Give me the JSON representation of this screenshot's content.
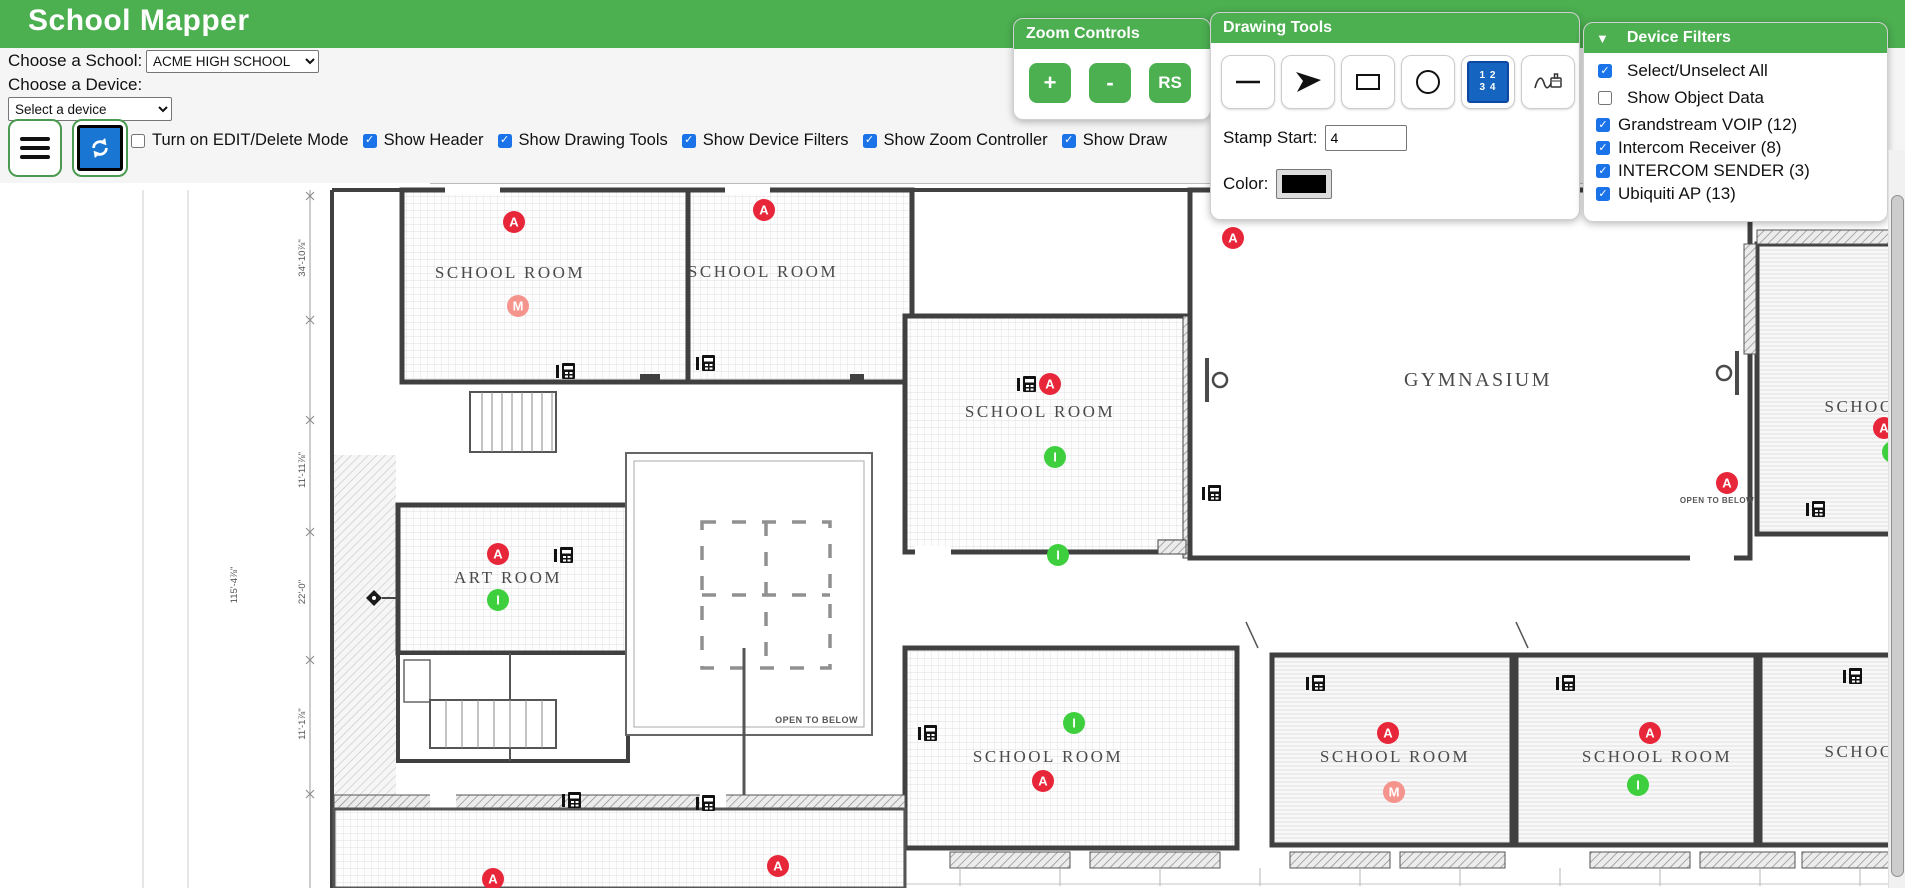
{
  "header": {
    "title": "School Mapper",
    "accent_color": "#4caf50"
  },
  "controls": {
    "school_label": "Choose a School:",
    "school_value": "ACME HIGH SCHOOL",
    "device_label": "Choose a Device:",
    "device_value": "Select a device"
  },
  "option_row": [
    {
      "label": "Turn on EDIT/Delete Mode",
      "checked": false
    },
    {
      "label": "Show Header",
      "checked": true
    },
    {
      "label": "Show Drawing Tools",
      "checked": true
    },
    {
      "label": "Show Device Filters",
      "checked": true
    },
    {
      "label": "Show Zoom Controller",
      "checked": true
    },
    {
      "label": "Show Draw",
      "checked": true
    }
  ],
  "zoom_controls": {
    "title": "Zoom Controls",
    "zoom_in": "+",
    "zoom_out": "-",
    "reset": "RS"
  },
  "drawing_tools": {
    "title": "Drawing Tools",
    "tools": [
      "line",
      "arrow",
      "rectangle",
      "circle",
      "number-stamp",
      "freehand-stamp"
    ],
    "stamp_icon_rows": [
      "1 2",
      "3 4"
    ],
    "stamp_start_label": "Stamp Start:",
    "stamp_start_value": "4",
    "color_label": "Color:",
    "color_value": "#000000"
  },
  "device_filters": {
    "title": "Device Filters",
    "collapse_icon": "▼",
    "items": [
      {
        "label": "Select/Unselect All",
        "checked": true,
        "group": "loose"
      },
      {
        "label": "Show Object Data",
        "checked": false,
        "group": "loose"
      },
      {
        "label": "Grandstream VOIP (12)",
        "checked": true,
        "group": "tight"
      },
      {
        "label": "Intercom Receiver (8)",
        "checked": true,
        "group": "tight"
      },
      {
        "label": "INTERCOM SENDER (3)",
        "checked": true,
        "group": "tight"
      },
      {
        "label": "Ubiquiti AP (13)",
        "checked": true,
        "group": "tight"
      }
    ]
  },
  "map": {
    "room_labels": [
      {
        "text": "SCHOOL ROOM",
        "x": 510,
        "y": 278,
        "size": 17
      },
      {
        "text": "SCHOOL ROOM",
        "x": 763,
        "y": 277,
        "size": 17
      },
      {
        "text": "SCHOOL ROOM",
        "x": 1040,
        "y": 417,
        "size": 17
      },
      {
        "text": "GYMNASIUM",
        "x": 1478,
        "y": 386,
        "size": 20
      },
      {
        "text": "SCHOOL",
        "x": 1866,
        "y": 412,
        "size": 17
      },
      {
        "text": "ART ROOM",
        "x": 508,
        "y": 583,
        "size": 17
      },
      {
        "text": "SCHOOL ROOM",
        "x": 1048,
        "y": 762,
        "size": 17
      },
      {
        "text": "SCHOOL ROOM",
        "x": 1395,
        "y": 762,
        "size": 17
      },
      {
        "text": "SCHOOL ROOM",
        "x": 1657,
        "y": 762,
        "size": 17
      },
      {
        "text": "SCHOOL",
        "x": 1866,
        "y": 757,
        "size": 17
      }
    ],
    "annotations": [
      {
        "text": "OPEN TO BELOW",
        "x": 858,
        "y": 723,
        "size": 9,
        "anchor": "end"
      },
      {
        "text": "OPEN TO BELOW",
        "x": 1717,
        "y": 503,
        "size": 8,
        "anchor": "middle"
      }
    ],
    "dimensions": [
      {
        "text": "34'-10⅞\"",
        "x": 305,
        "y": 258
      },
      {
        "text": "11'-11⅞\"",
        "x": 305,
        "y": 470
      },
      {
        "text": "22'-0\"",
        "x": 305,
        "y": 592
      },
      {
        "text": "11'-1⅞\"",
        "x": 305,
        "y": 724
      },
      {
        "text": "115'-4⅞\"",
        "x": 237,
        "y": 585
      }
    ],
    "marker_colors": {
      "A": "#e82639",
      "I": "#3ecf3e",
      "M": "#f4948c"
    },
    "markers": [
      {
        "letter": "A",
        "x": 514,
        "y": 222
      },
      {
        "letter": "A",
        "x": 764,
        "y": 210
      },
      {
        "letter": "A",
        "x": 1233,
        "y": 238
      },
      {
        "letter": "A",
        "x": 1050,
        "y": 384
      },
      {
        "letter": "A",
        "x": 498,
        "y": 554
      },
      {
        "letter": "A",
        "x": 1727,
        "y": 483
      },
      {
        "letter": "A",
        "x": 1884,
        "y": 428
      },
      {
        "letter": "A",
        "x": 1043,
        "y": 781
      },
      {
        "letter": "A",
        "x": 1388,
        "y": 733
      },
      {
        "letter": "A",
        "x": 1650,
        "y": 733
      },
      {
        "letter": "A",
        "x": 778,
        "y": 866
      },
      {
        "letter": "A",
        "x": 493,
        "y": 879
      },
      {
        "letter": "I",
        "x": 1055,
        "y": 457
      },
      {
        "letter": "I",
        "x": 1058,
        "y": 555
      },
      {
        "letter": "I",
        "x": 498,
        "y": 600
      },
      {
        "letter": "I",
        "x": 1074,
        "y": 723
      },
      {
        "letter": "I",
        "x": 1638,
        "y": 785
      },
      {
        "letter": "I",
        "x": 1893,
        "y": 452
      },
      {
        "letter": "M",
        "x": 518,
        "y": 306
      },
      {
        "letter": "M",
        "x": 1394,
        "y": 792
      }
    ],
    "phone_positions": [
      [
        556,
        363
      ],
      [
        696,
        355
      ],
      [
        1017,
        376
      ],
      [
        1202,
        485
      ],
      [
        554,
        547
      ],
      [
        918,
        725
      ],
      [
        1306,
        675
      ],
      [
        1556,
        675
      ],
      [
        1843,
        668
      ],
      [
        1806,
        501
      ],
      [
        562,
        792
      ],
      [
        696,
        795
      ]
    ],
    "door_positions": [
      {
        "x": 1207,
        "y": 380,
        "flip": -1
      },
      {
        "x": 1737,
        "y": 373,
        "flip": 1
      }
    ]
  }
}
